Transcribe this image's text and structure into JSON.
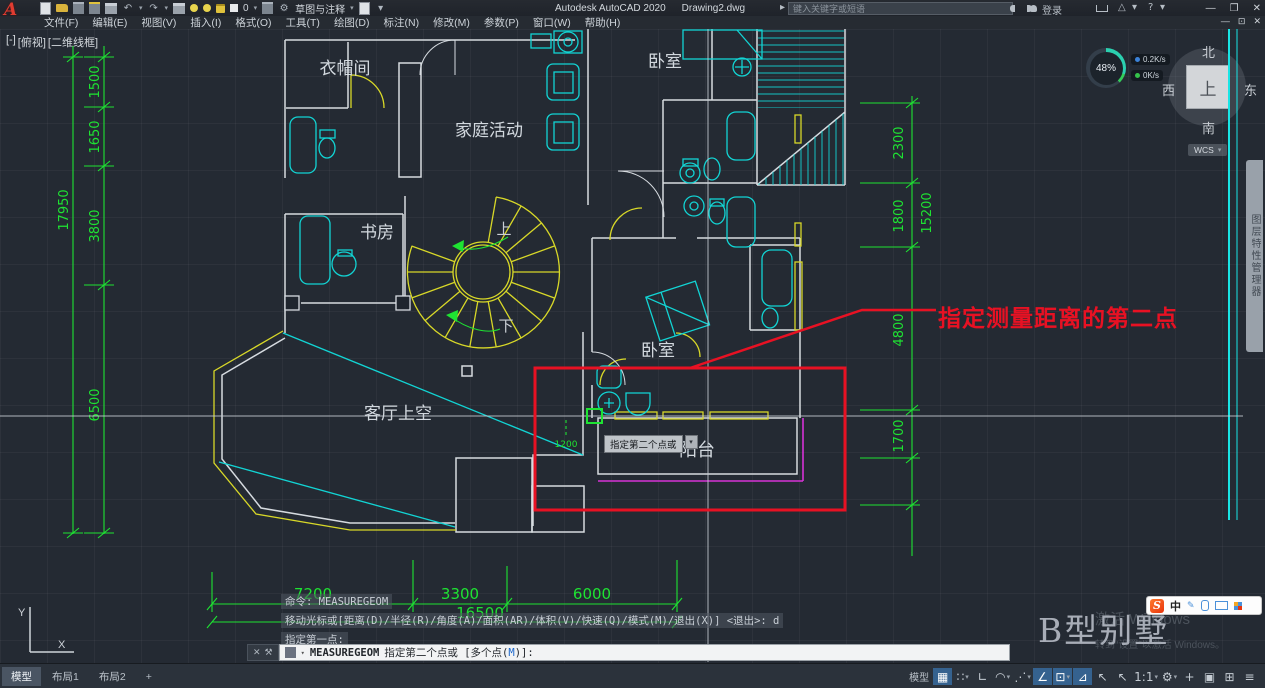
{
  "titlebar": {
    "app_title": "Autodesk AutoCAD 2020",
    "doc_title": "Drawing2.dwg",
    "search_placeholder": "键入关键字或短语",
    "sign_in_label": "登录",
    "layer_value": "0",
    "workspace_value": "草图与注释"
  },
  "menubar": {
    "items": [
      "文件(F)",
      "编辑(E)",
      "视图(V)",
      "插入(I)",
      "格式(O)",
      "工具(T)",
      "绘图(D)",
      "标注(N)",
      "修改(M)",
      "参数(P)",
      "窗口(W)",
      "帮助(H)"
    ]
  },
  "viewport_controls": {
    "minus": "[-]",
    "view": "[俯视]",
    "visual_style": "[二维线框]"
  },
  "performance_gauge": {
    "percent": "48%",
    "up_rate": "0.2K/s",
    "down_rate": "0K/s"
  },
  "viewcube": {
    "north": "北",
    "west": "西",
    "east": "东",
    "south": "南",
    "top": "上",
    "wcs_label": "WCS"
  },
  "right_palette_tab": {
    "label": "图层特性管理器"
  },
  "plan": {
    "rooms": {
      "cloakroom": "衣帽间",
      "family_area": "家庭活动",
      "bedroom_top": "卧室",
      "study": "书房",
      "stair_up": "上",
      "stair_down": "下",
      "bedroom_mid": "卧室",
      "living_void": "客厅上空",
      "balcony": "阳台"
    },
    "dims": {
      "left": [
        "1500",
        "1650",
        "3800",
        "17950",
        "6500"
      ],
      "right": [
        "2300",
        "1800",
        "15200",
        "4800",
        "1700"
      ],
      "bottom": [
        "7200",
        "3300",
        "6000",
        "16500"
      ],
      "cursor_dim": "1200"
    },
    "ucs": {
      "x_label": "X",
      "y_label": "Y"
    }
  },
  "annotation": {
    "label": "指定测量距离的第二点"
  },
  "tooltip": {
    "label": "指定第二个点或"
  },
  "command_history": {
    "line1": "命令: MEASUREGEOM",
    "line2": "移动光标或[距离(D)/半径(R)/角度(A)/面积(AR)/体积(V)/快速(Q)/模式(M)/退出(X)] <退出>: d",
    "line3": "指定第一点:"
  },
  "command_line": {
    "command": "MEASUREGEOM",
    "prompt_prefix": "指定第二个点或 [多个点(",
    "prompt_key": "M",
    "prompt_suffix": ")]:"
  },
  "layout_tabs": {
    "model": "模型",
    "layout1": "布局1",
    "layout2": "布局2",
    "add": "+"
  },
  "statusbar": {
    "space_label": "模型",
    "scale_label": "1:1"
  },
  "watermark": {
    "title": "B型别墅",
    "activate_line1": "激活 Windows",
    "activate_line2": "转到“设置”以激活 Windows。"
  },
  "ime_bar": {
    "mode": "中"
  },
  "icons": {
    "caret": "▾",
    "minimize": "—",
    "maximize": "❐",
    "close": "✕",
    "restore": "⊡",
    "undo": "↶",
    "redo": "↷",
    "gear": "⚙",
    "menu": "≡",
    "help": "?",
    "triangle": "△",
    "grid": "▦",
    "snap": "∷",
    "ortho": "∟",
    "polar": "◠",
    "isodraft": "⋰",
    "otrack": "∠",
    "dyninput": "⊡",
    "osnap": "⊿",
    "cursor": "↖",
    "plus": "+",
    "isolate": "▣",
    "cleanscreen": "⊞",
    "cmd_close": "✕",
    "cmd_tools": "⚒",
    "pen": "✎",
    "arrow_right": "▸"
  },
  "colors": {
    "dim_green": "#1ee332",
    "annotation_red": "#e81123",
    "wall_gray": "#d6dbe0",
    "fixture_cyan": "#12d4d4",
    "window_yellow": "#d8d828",
    "balcony_magenta": "#d633d6",
    "active_blue": "#35628f"
  }
}
